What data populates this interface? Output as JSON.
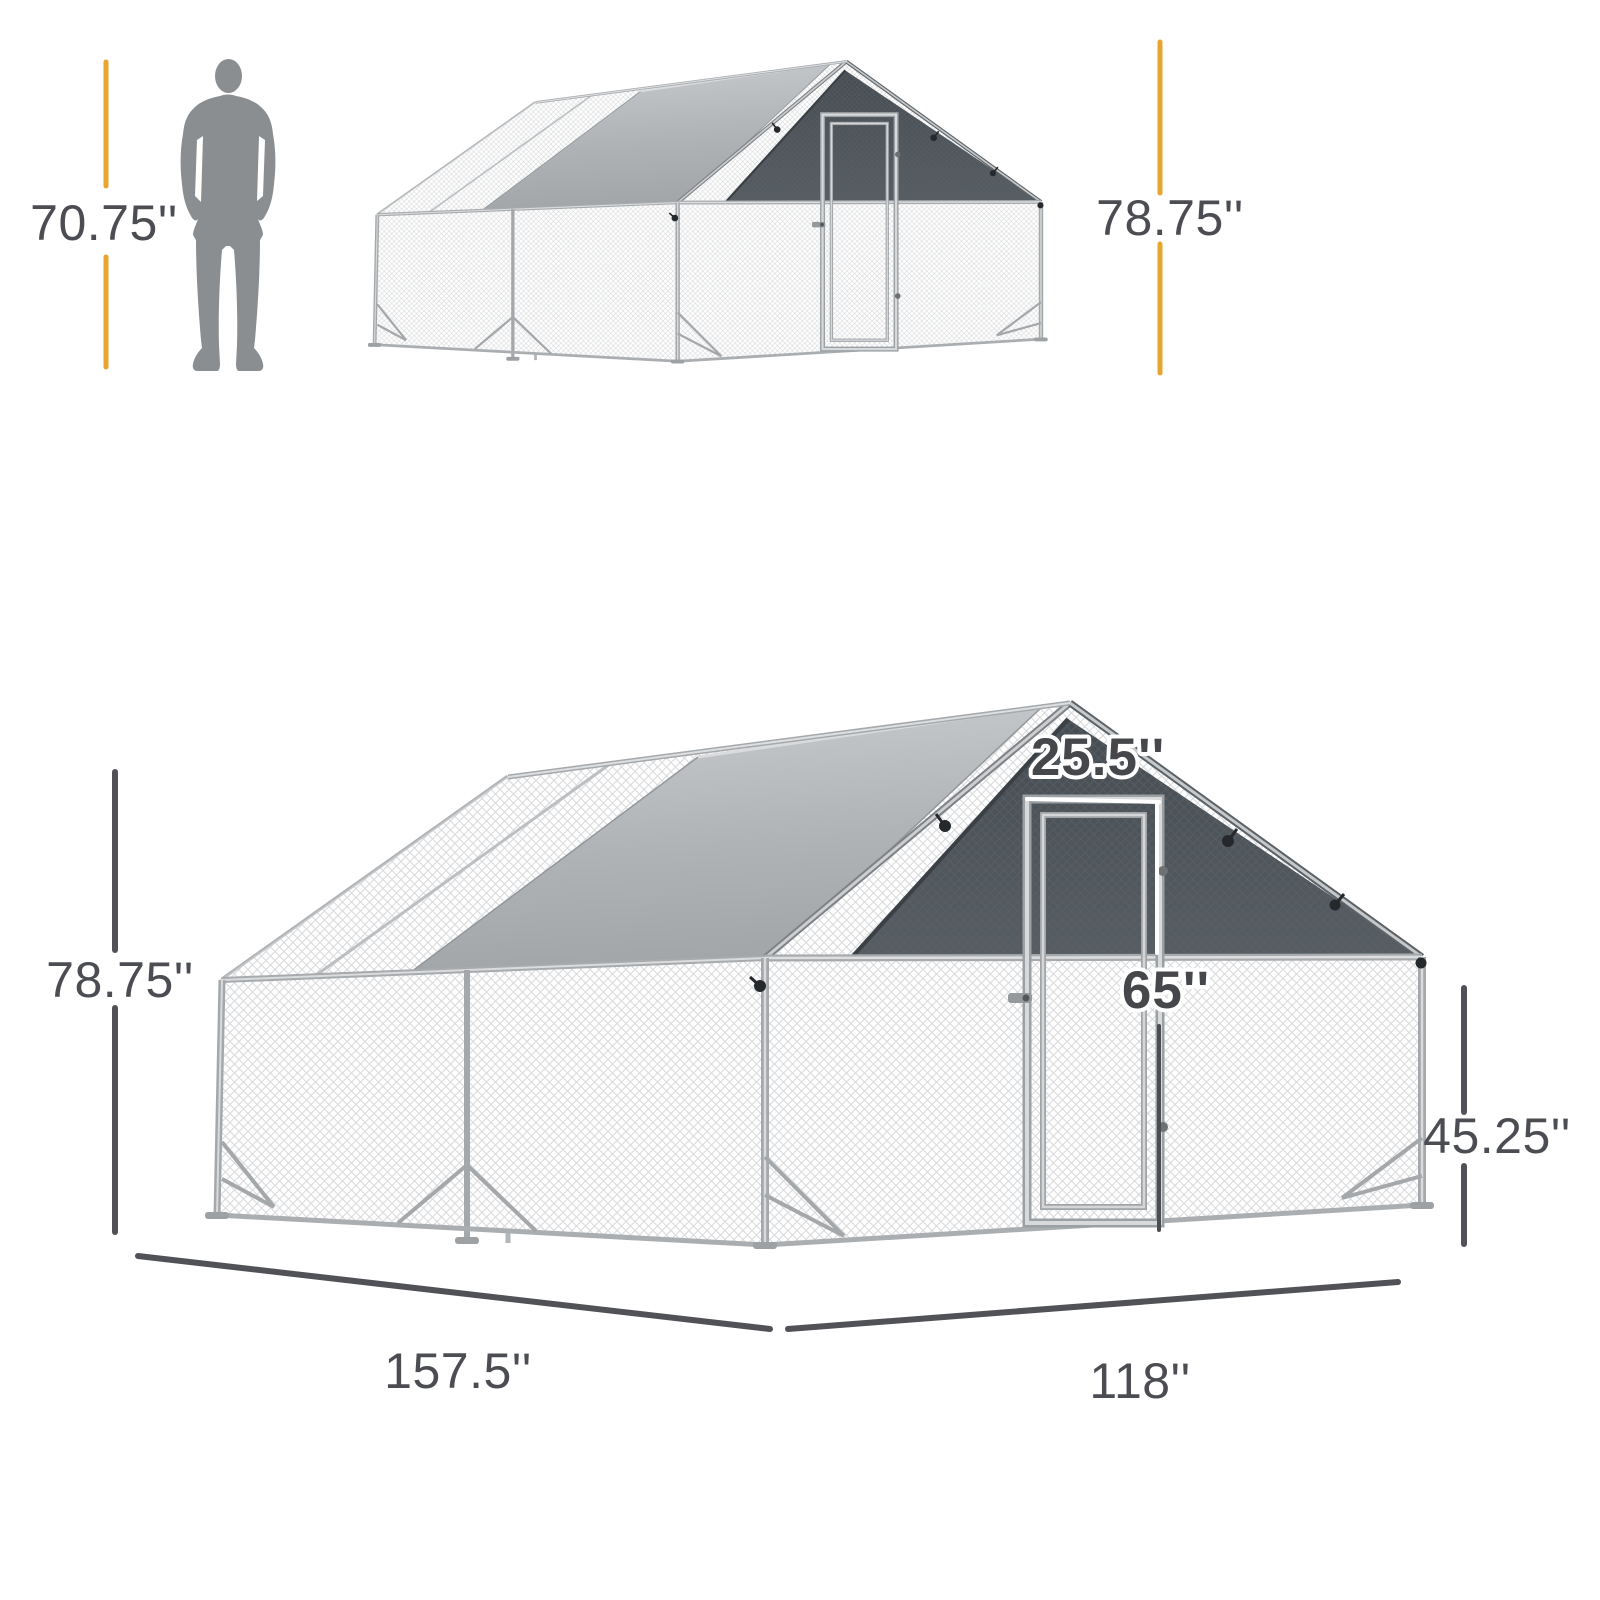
{
  "product_diagram": {
    "description": "walk-in-chicken-run-dimension-diagram",
    "scale_view": {
      "person_height_label": "70.75''",
      "total_height_label": "78.75''"
    },
    "dimension_view": {
      "total_height_label": "78.75''",
      "door_width_label": "25.5''",
      "door_height_label": "65''",
      "side_wall_height_label": "45.25''",
      "length_label": "157.5''",
      "depth_label": "118''"
    },
    "colors": {
      "accent_line": "#E8A52F",
      "dimension_line": "#515257",
      "label_text": "#4B4D52",
      "door_label_text": "#45474B",
      "door_label_outline": "#FFFFFF",
      "person_silhouette": "#8B8E91",
      "roof_tarp": "#B0B3B6",
      "shade_cover": "#4C535A",
      "frame_metal": "#A8ABAE",
      "wire_mesh": "#D8D9DB"
    }
  }
}
